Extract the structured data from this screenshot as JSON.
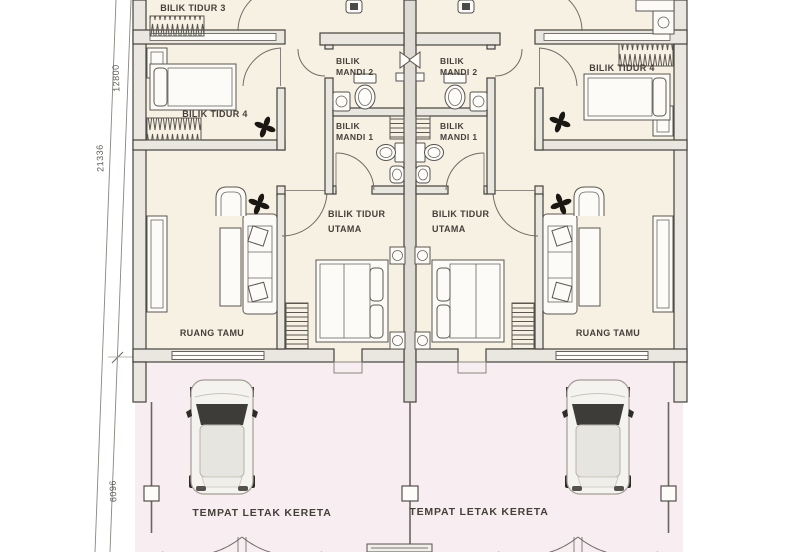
{
  "plan": {
    "labels": {
      "bedroom3": "BILIK TIDUR 3",
      "bedroom4": "BILIK TIDUR 4",
      "bath2_line1": "BILIK",
      "bath2_line2": "MANDI 2",
      "bath1_line1": "BILIK",
      "bath1_line2": "MANDI 1",
      "master_line1": "BILIK TIDUR",
      "master_line2": "UTAMA",
      "living": "RUANG TAMU",
      "carporch": "TEMPAT LETAK KERETA"
    },
    "dimensions": {
      "overall_depth": "21336",
      "house_depth": "12800",
      "porch_depth": "6096"
    },
    "colors": {
      "floor": "#f7f1e4",
      "porch": "#f8edf0",
      "wall_line": "#45423e",
      "text": "#44403a"
    }
  }
}
